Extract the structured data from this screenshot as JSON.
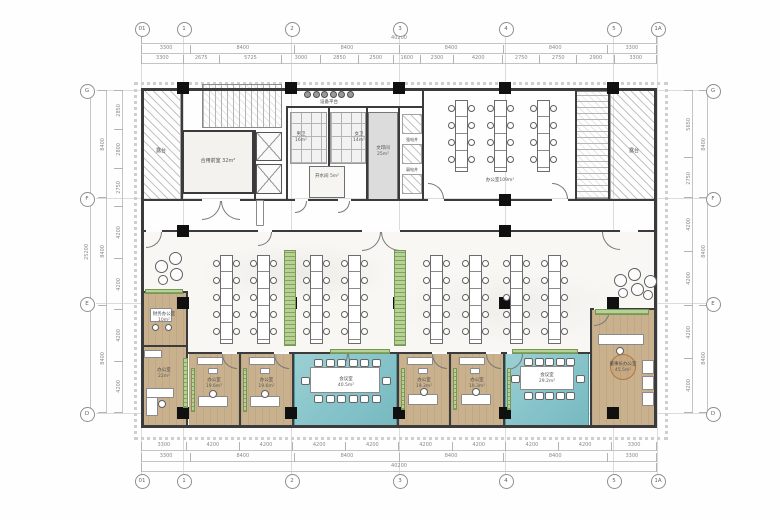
{
  "grid": {
    "cols": [
      "01",
      "1",
      "2",
      "3",
      "4",
      "5",
      "1A"
    ],
    "rows": [
      "G",
      "F",
      "E",
      "D"
    ]
  },
  "dimensions": {
    "top_total": [
      "40200"
    ],
    "top_major": [
      "3300",
      "8400",
      "8400",
      "8400",
      "8400",
      "3300"
    ],
    "top_minor": [
      "3300",
      "2675",
      "5725",
      "3000",
      "2850",
      "2500",
      "1600",
      "2300",
      "4200",
      "2750",
      "2750",
      "2900",
      "3300"
    ],
    "bottom_minor": [
      "3300",
      "4200",
      "4200",
      "4200",
      "4200",
      "4200",
      "4200",
      "4200",
      "4200",
      "3300"
    ],
    "bottom_major": [
      "3300",
      "8400",
      "8400",
      "8400",
      "8400",
      "3300"
    ],
    "bottom_total": [
      "40200"
    ],
    "left_total": [
      "25200"
    ],
    "left_major": [
      "8400",
      "8400",
      "8400"
    ],
    "left_minor": [
      "2850",
      "2800",
      "2750",
      "4200",
      "4200",
      "4200",
      "4200"
    ],
    "right_major": [
      "8400",
      "8400",
      "8400"
    ],
    "right_minor": [
      "5650",
      "2750",
      "4200",
      "4200",
      "4200",
      "4200"
    ]
  },
  "rooms": {
    "terrace_left": {
      "name": "露台"
    },
    "terrace_right": {
      "name": "露台"
    },
    "lobby": {
      "name": "合用前室",
      "area": "32m²"
    },
    "mens": {
      "name": "男卫",
      "area": "16m²"
    },
    "womens": {
      "name": "女卫",
      "area": "14m²"
    },
    "hot_water": {
      "name": "开水间",
      "area": "5m²"
    },
    "equipment": {
      "name": "设备平台"
    },
    "print": {
      "name": "文印间",
      "area": "25m²"
    },
    "shaft_a": {
      "name": "强电井"
    },
    "shaft_b": {
      "name": "弱电井"
    },
    "office_top": {
      "name": "办公室",
      "area": "109m²"
    },
    "finance": {
      "name": "财务办公室",
      "area": "10m²"
    },
    "office_22": {
      "name": "办公室",
      "area": "22m²"
    },
    "office_a": {
      "name": "办公室",
      "area": "19.6m²"
    },
    "office_b": {
      "name": "办公室",
      "area": "19.6m²"
    },
    "conf_big": {
      "name": "会议室",
      "area": "40.5m²"
    },
    "office_c": {
      "name": "办公室",
      "area": "19.3m²"
    },
    "office_d": {
      "name": "办公室",
      "area": "19.3m²"
    },
    "conf_small": {
      "name": "会议室",
      "area": "29.2m²"
    },
    "exec": {
      "name": "董事长办公室",
      "area": "45.5m²"
    }
  },
  "colors": {
    "wood": "#c9b18e",
    "teal": "#83c2c8",
    "planter_green": "#b7d193",
    "wall": "#3b3b3b",
    "dim_text": "#8a8a8a"
  }
}
